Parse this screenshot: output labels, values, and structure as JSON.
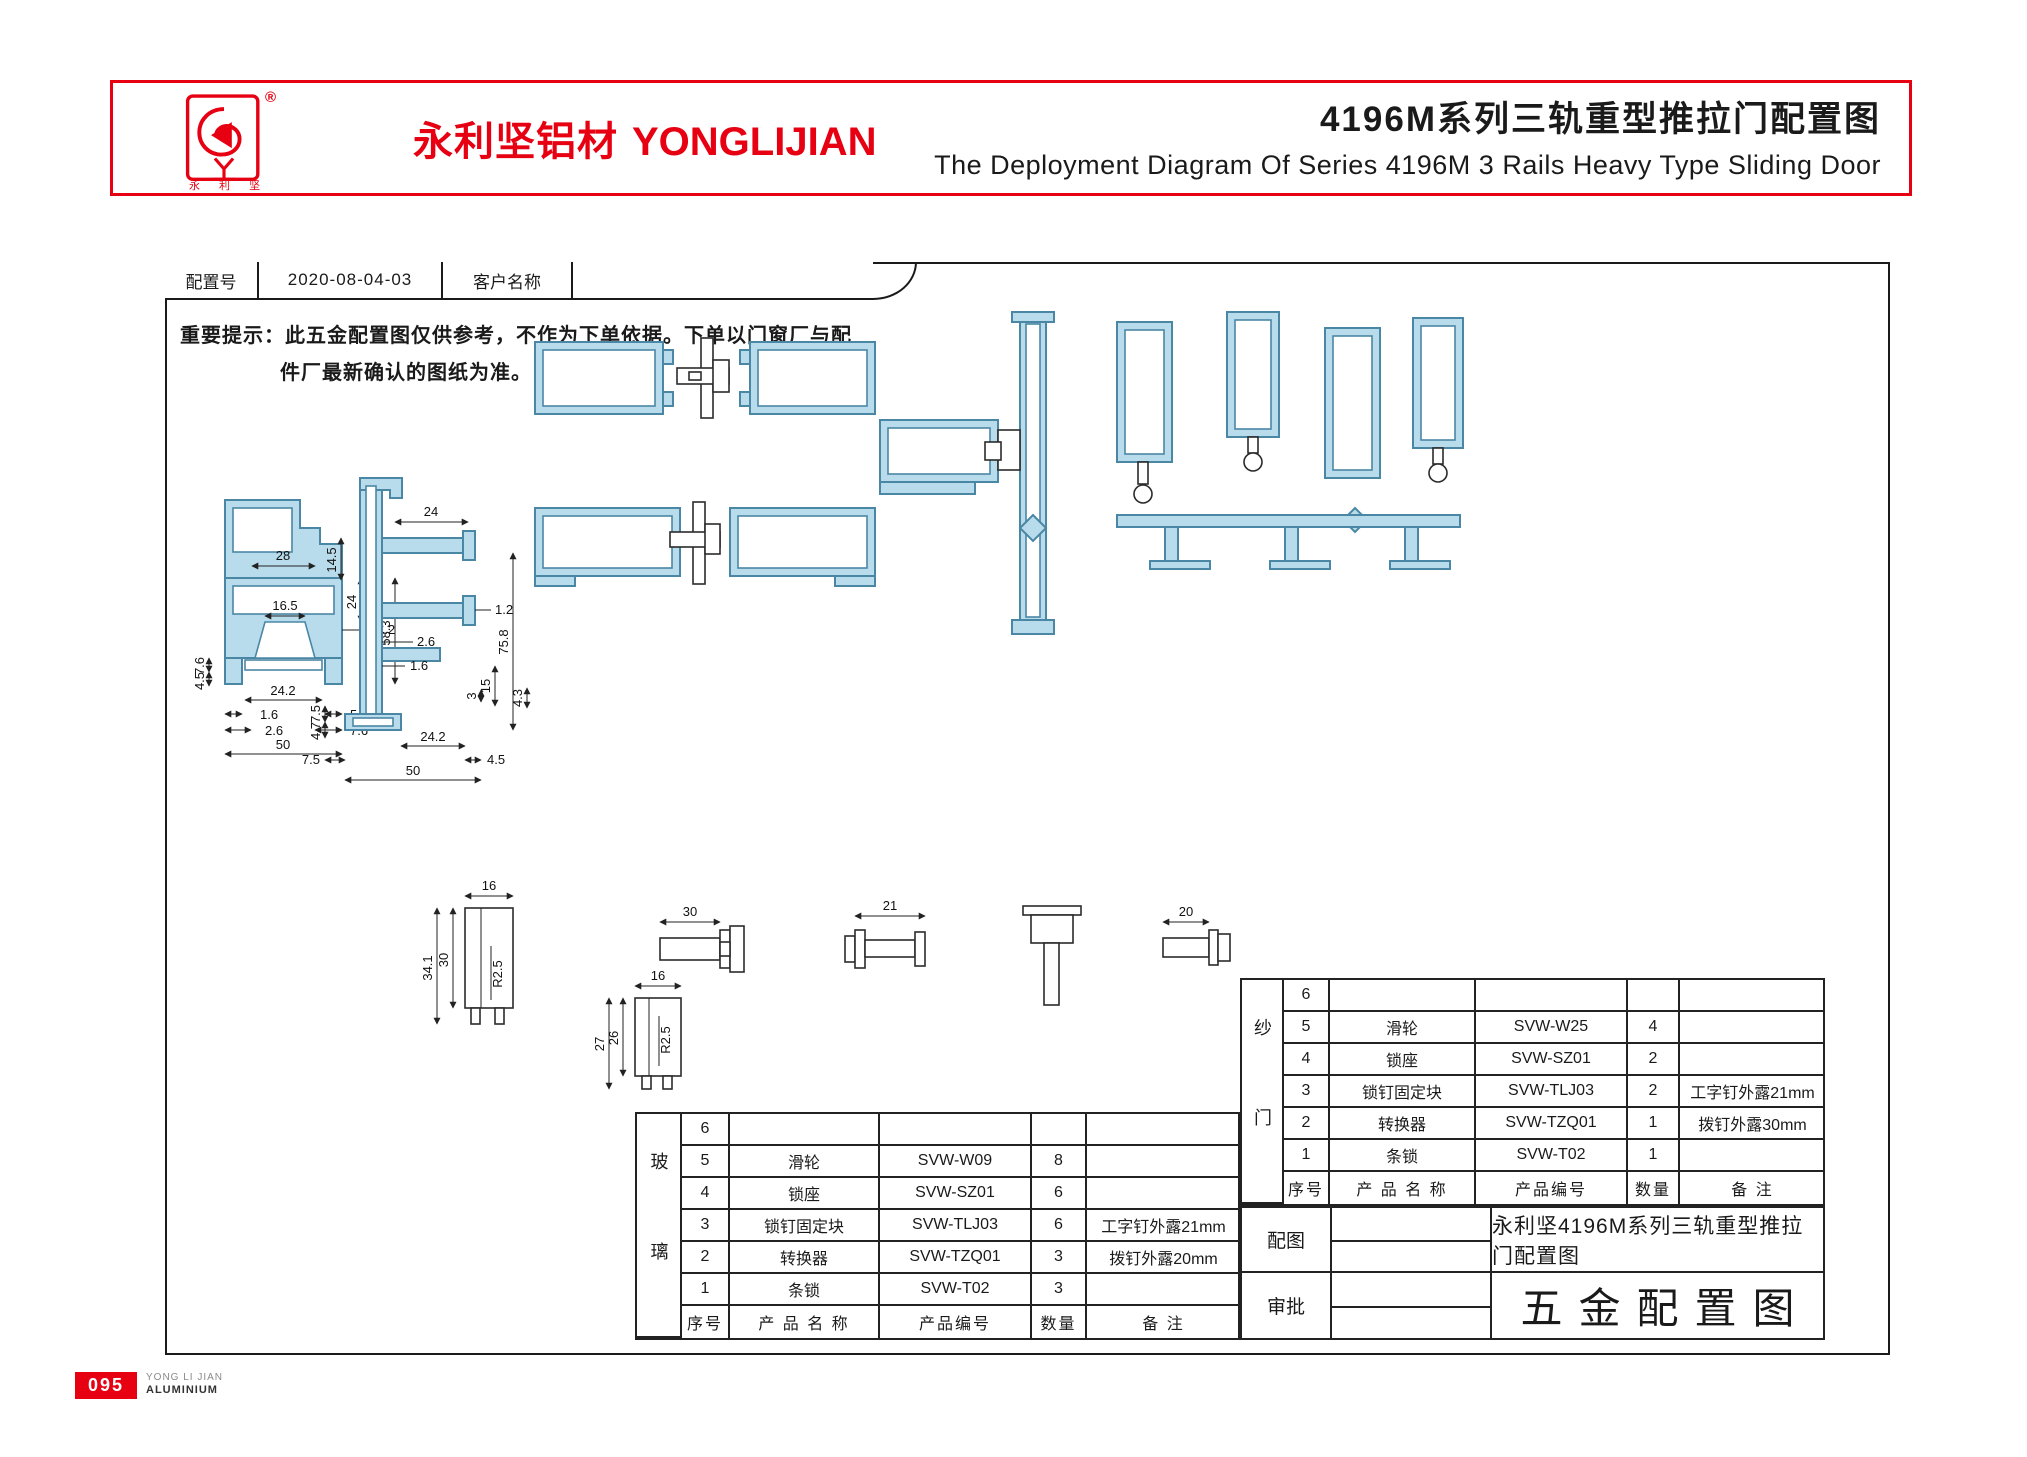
{
  "header": {
    "reg_mark": "®",
    "logo_sub": "永 利 坚",
    "brand_cn": "永利坚铝材",
    "brand_en": "YONGLIJIAN",
    "title_cn": "4196M系列三轨重型推拉门配置图",
    "title_en": "The Deployment Diagram Of Series 4196M 3 Rails Heavy Type Sliding Door"
  },
  "config_bar": {
    "label_config_no": "配置号",
    "config_no": "2020-08-04-03",
    "label_customer": "客户名称",
    "customer": ""
  },
  "notice": {
    "line1": "重要提示：此五金配置图仅供参考，不作为下单依据。下单以门窗厂与配",
    "line2": "件厂最新确认的图纸为准。"
  },
  "drawings": {
    "p1": [
      "28",
      "16.5",
      "24",
      "1.2",
      "58.3",
      "2.1",
      "3.3",
      "15",
      "7.6",
      "4.5",
      "24.2",
      "1.6",
      "2.6",
      "5",
      "7.6",
      "50"
    ],
    "p2": [
      "24",
      "14.5",
      "2.6",
      "1.6",
      "75.8",
      "1.2",
      "15",
      "3",
      "4.3",
      "7.5",
      "4.7",
      "24.2",
      "4.5",
      "50",
      "7.5"
    ],
    "roller": [
      "16",
      "34.1",
      "30",
      "R2.5"
    ],
    "block": [
      "16",
      "27",
      "26",
      "R2.5"
    ],
    "pin30": "30",
    "pin21": "21",
    "pin20": "20"
  },
  "glass_table": {
    "category": "玻璃",
    "headers": [
      "序号",
      "产 品 名 称",
      "产品编号",
      "数量",
      "备  注"
    ],
    "rows": [
      {
        "no": "6",
        "name": "",
        "code": "",
        "qty": "",
        "note": ""
      },
      {
        "no": "5",
        "name": "滑轮",
        "code": "SVW-W09",
        "qty": "8",
        "note": ""
      },
      {
        "no": "4",
        "name": "锁座",
        "code": "SVW-SZ01",
        "qty": "6",
        "note": ""
      },
      {
        "no": "3",
        "name": "锁钉固定块",
        "code": "SVW-TLJ03",
        "qty": "6",
        "note": "工字钉外露21mm"
      },
      {
        "no": "2",
        "name": "转换器",
        "code": "SVW-TZQ01",
        "qty": "3",
        "note": "拨钉外露20mm"
      },
      {
        "no": "1",
        "name": "条锁",
        "code": "SVW-T02",
        "qty": "3",
        "note": ""
      }
    ]
  },
  "screen_table": {
    "category": "纱门",
    "headers": [
      "序号",
      "产 品 名 称",
      "产品编号",
      "数量",
      "备  注"
    ],
    "rows": [
      {
        "no": "6",
        "name": "",
        "code": "",
        "qty": "",
        "note": ""
      },
      {
        "no": "5",
        "name": "滑轮",
        "code": "SVW-W25",
        "qty": "4",
        "note": ""
      },
      {
        "no": "4",
        "name": "锁座",
        "code": "SVW-SZ01",
        "qty": "2",
        "note": ""
      },
      {
        "no": "3",
        "name": "锁钉固定块",
        "code": "SVW-TLJ03",
        "qty": "2",
        "note": "工字钉外露21mm"
      },
      {
        "no": "2",
        "name": "转换器",
        "code": "SVW-TZQ01",
        "qty": "1",
        "note": "拨钉外露30mm"
      },
      {
        "no": "1",
        "name": "条锁",
        "code": "SVW-T02",
        "qty": "1",
        "note": ""
      }
    ]
  },
  "title_block": {
    "row1_label": "配图",
    "row1_value": "永利坚4196M系列三轨重型推拉门配置图",
    "row2_label": "审批",
    "row2_value": "五金配置图"
  },
  "footer": {
    "page": "095",
    "brand_line1": "YONG LI JIAN",
    "brand_line2": "ALUMINIUM"
  },
  "colors": {
    "brand_red": "#e60012",
    "profile_fill": "#b9dcec",
    "profile_stroke": "#4a87a5"
  }
}
